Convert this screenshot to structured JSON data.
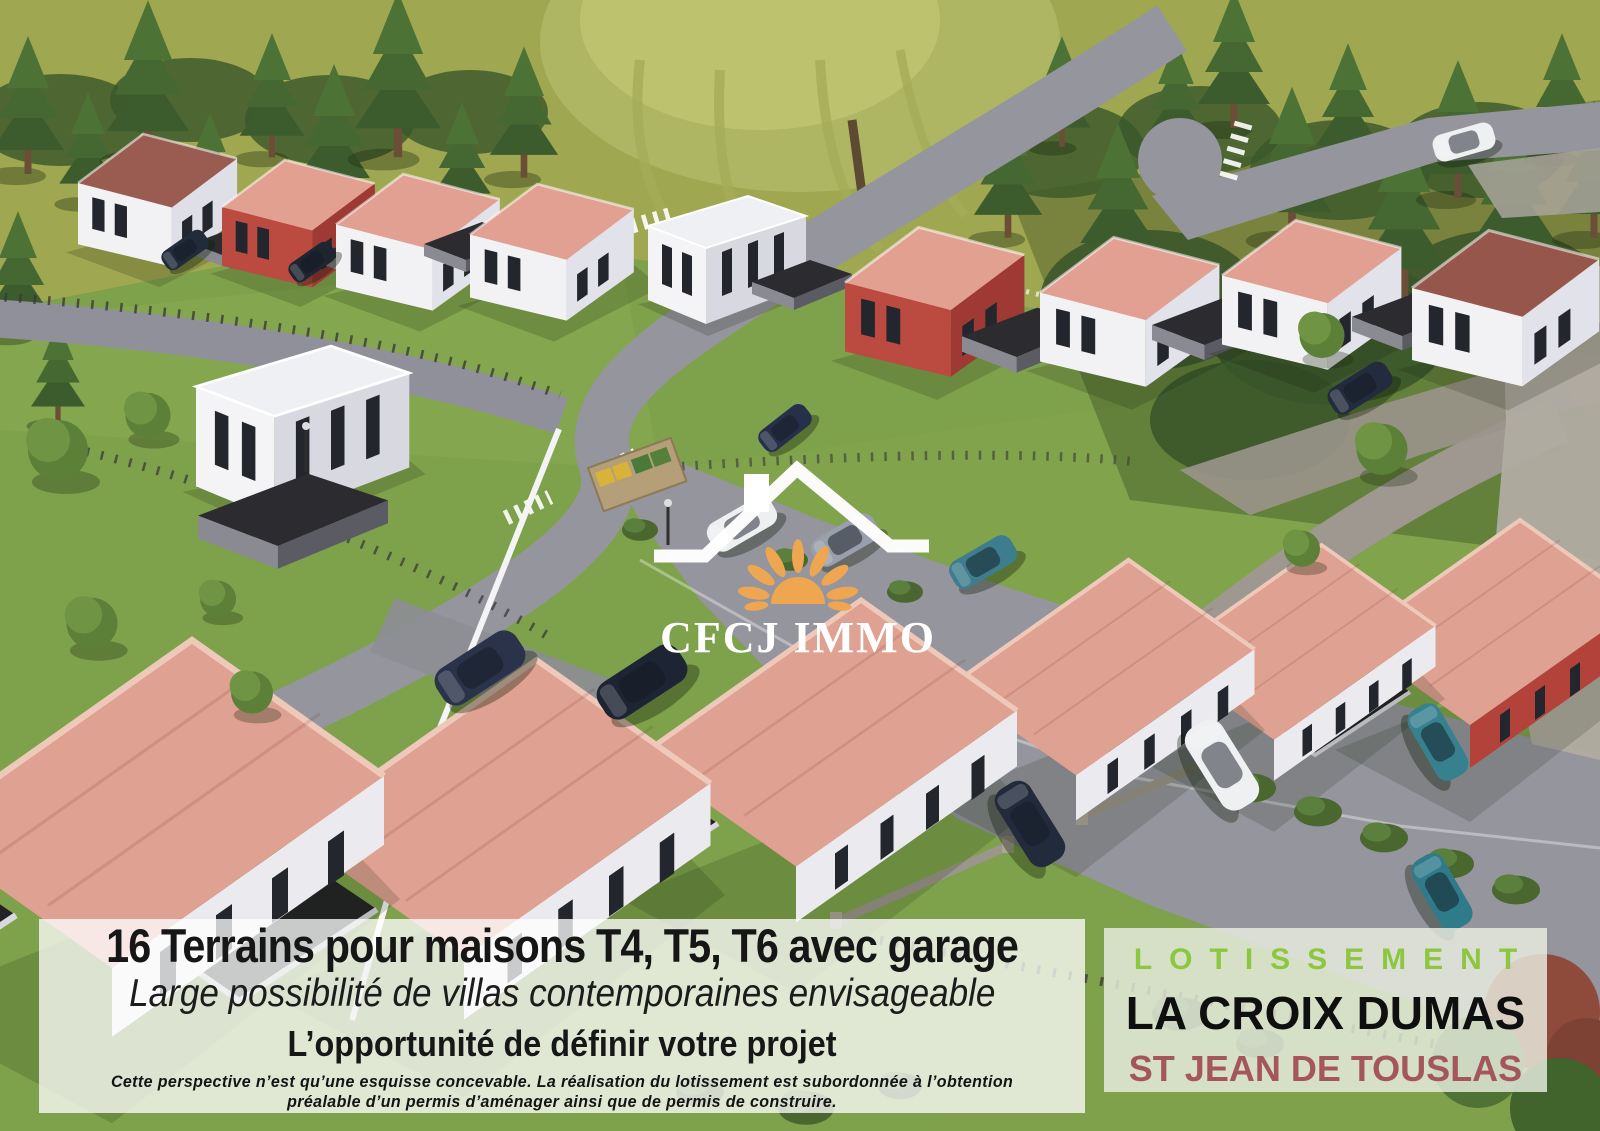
{
  "logo": {
    "brand": "CFCJ IMMO"
  },
  "banner": {
    "headline": "16 Terrains pour maisons T4, T5, T6 avec garage",
    "subheadline": "Large possibilité de villas contemporaines envisageable",
    "tagline": "L’opportunité de définir votre projet",
    "disclaimer_line1": "Cette perspective n’est qu’une esquisse concevable. La réalisation du lotissement est subordonnée à l’obtention",
    "disclaimer_line2": "préalable  d’un permis d’aménager ainsi que de permis de construire."
  },
  "project_panel": {
    "label": "LOTISSEMENT",
    "name": "LA CROIX DUMAS",
    "location": "ST JEAN DE TOUSLAS"
  },
  "colors": {
    "panel_label_green": "#8dc63f",
    "panel_name_black": "#0f0f0f",
    "panel_location_red": "#a4565a",
    "logo_sun_orange": "#efa651",
    "roof_salmon": "#e1a092",
    "roof_brown_red": "#96564b",
    "facade_red": "#b2423a",
    "grass_field": "#9fa750",
    "grass_lawn": "#7ea14b",
    "road_gray": "#95959d"
  }
}
